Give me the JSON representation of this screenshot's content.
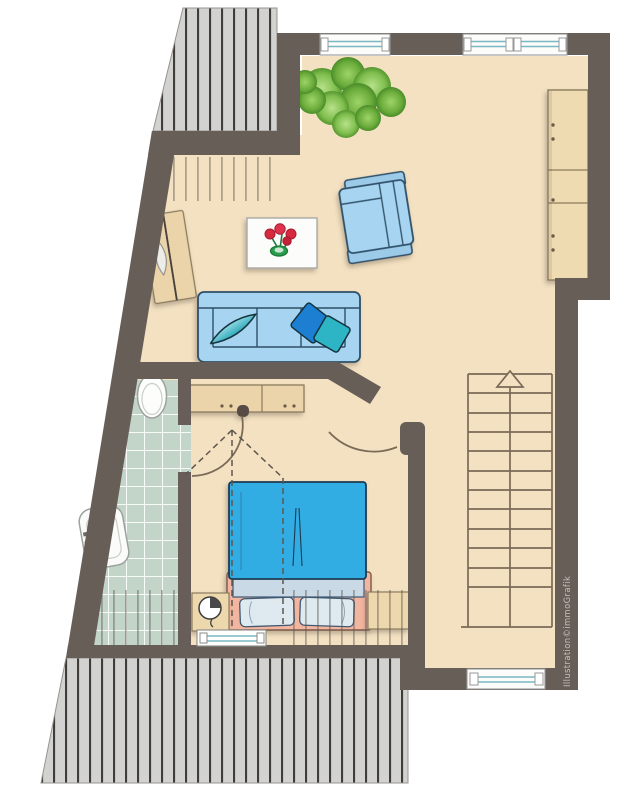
{
  "credit": {
    "text": "Illustration©immoGrafik"
  },
  "palette": {
    "wall": "#675E58",
    "floor": "#F3E1C1",
    "terrace_deck": "#D2D2D0",
    "deck_stripe": "#403D39",
    "bathroom_tile": "#C3D5C9",
    "tile_grout": "#FFFFFF",
    "furniture_wood": "#EBD4A9",
    "sofa_blue": "#A7D5F1",
    "furniture_outline_blue": "#2F4F68",
    "bed_duvet_blue": "#31ADE3",
    "bed_linen_light": "#DEE9F0",
    "bed_frame_salmon": "#F2B5A0",
    "cushion_teal": "#2FB5C5",
    "cushion_deep_blue": "#1F7FD1",
    "plant_green": "#7FBE4E",
    "flower_red": "#D6293E",
    "stair_line_brown": "#7A6A57",
    "window_glass_teal": "#79B8C4",
    "credit_text_gray": "#C6C0BA"
  },
  "floor_plan": {
    "type": "attic-apartment-floor-plan",
    "rooms": [
      "living-area",
      "bedroom",
      "bathroom",
      "stair-hall",
      "roof-terrace-top-left",
      "roof-terrace-bottom"
    ],
    "stairs": {
      "direction": "up-arrow",
      "treads": 12
    },
    "windows": [
      "top-window-left",
      "top-window-right",
      "bottom-window",
      "bedroom-radiator-window"
    ],
    "doors": [
      "bathroom-door",
      "bedroom-door"
    ],
    "furniture": [
      "potted-plant",
      "tall-cabinet",
      "armchair",
      "coffee-table-with-tulips",
      "three-seat-sofa",
      "lens-cushion",
      "deep-blue-cushion",
      "teal-cushion",
      "angled-sideboard",
      "bedroom-sideboard",
      "double-bed",
      "nightstand-with-lamp",
      "nightstand",
      "toilet",
      "washbasin"
    ],
    "annotations": [
      "roof-slope-hatching",
      "headroom-dashed-lines"
    ]
  }
}
